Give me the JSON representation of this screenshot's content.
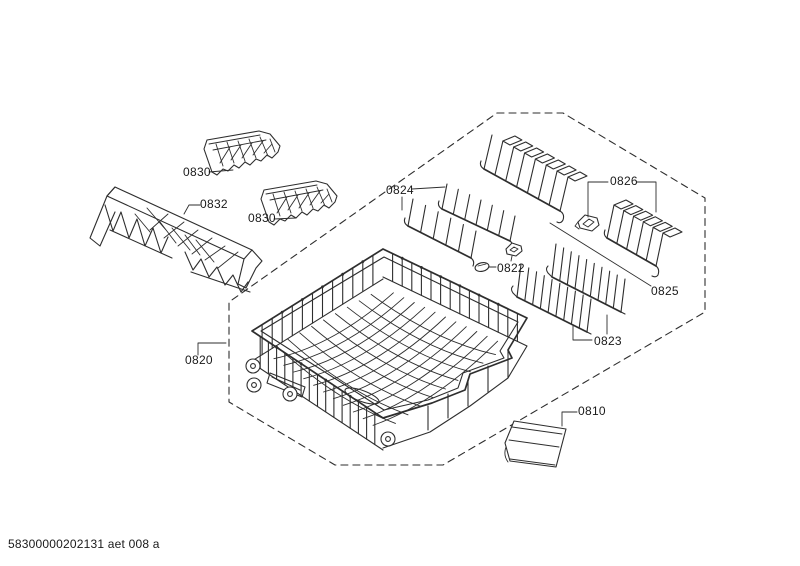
{
  "colors": {
    "background": "#ffffff",
    "line": "#2e2e2e",
    "text": "#1a1a1a"
  },
  "footer": {
    "doc_code": "58300000202131 aet 008 a"
  },
  "labels": {
    "insert_top": "0830",
    "shelf": "0832",
    "insert_right": "0830",
    "tine_rows_left": "0824",
    "tine_row_holder": "0826",
    "bearing_clips": "0822",
    "tine_row_top": "0825",
    "tine_rows_right": "0823",
    "basket": "0820",
    "tray": "0810"
  }
}
